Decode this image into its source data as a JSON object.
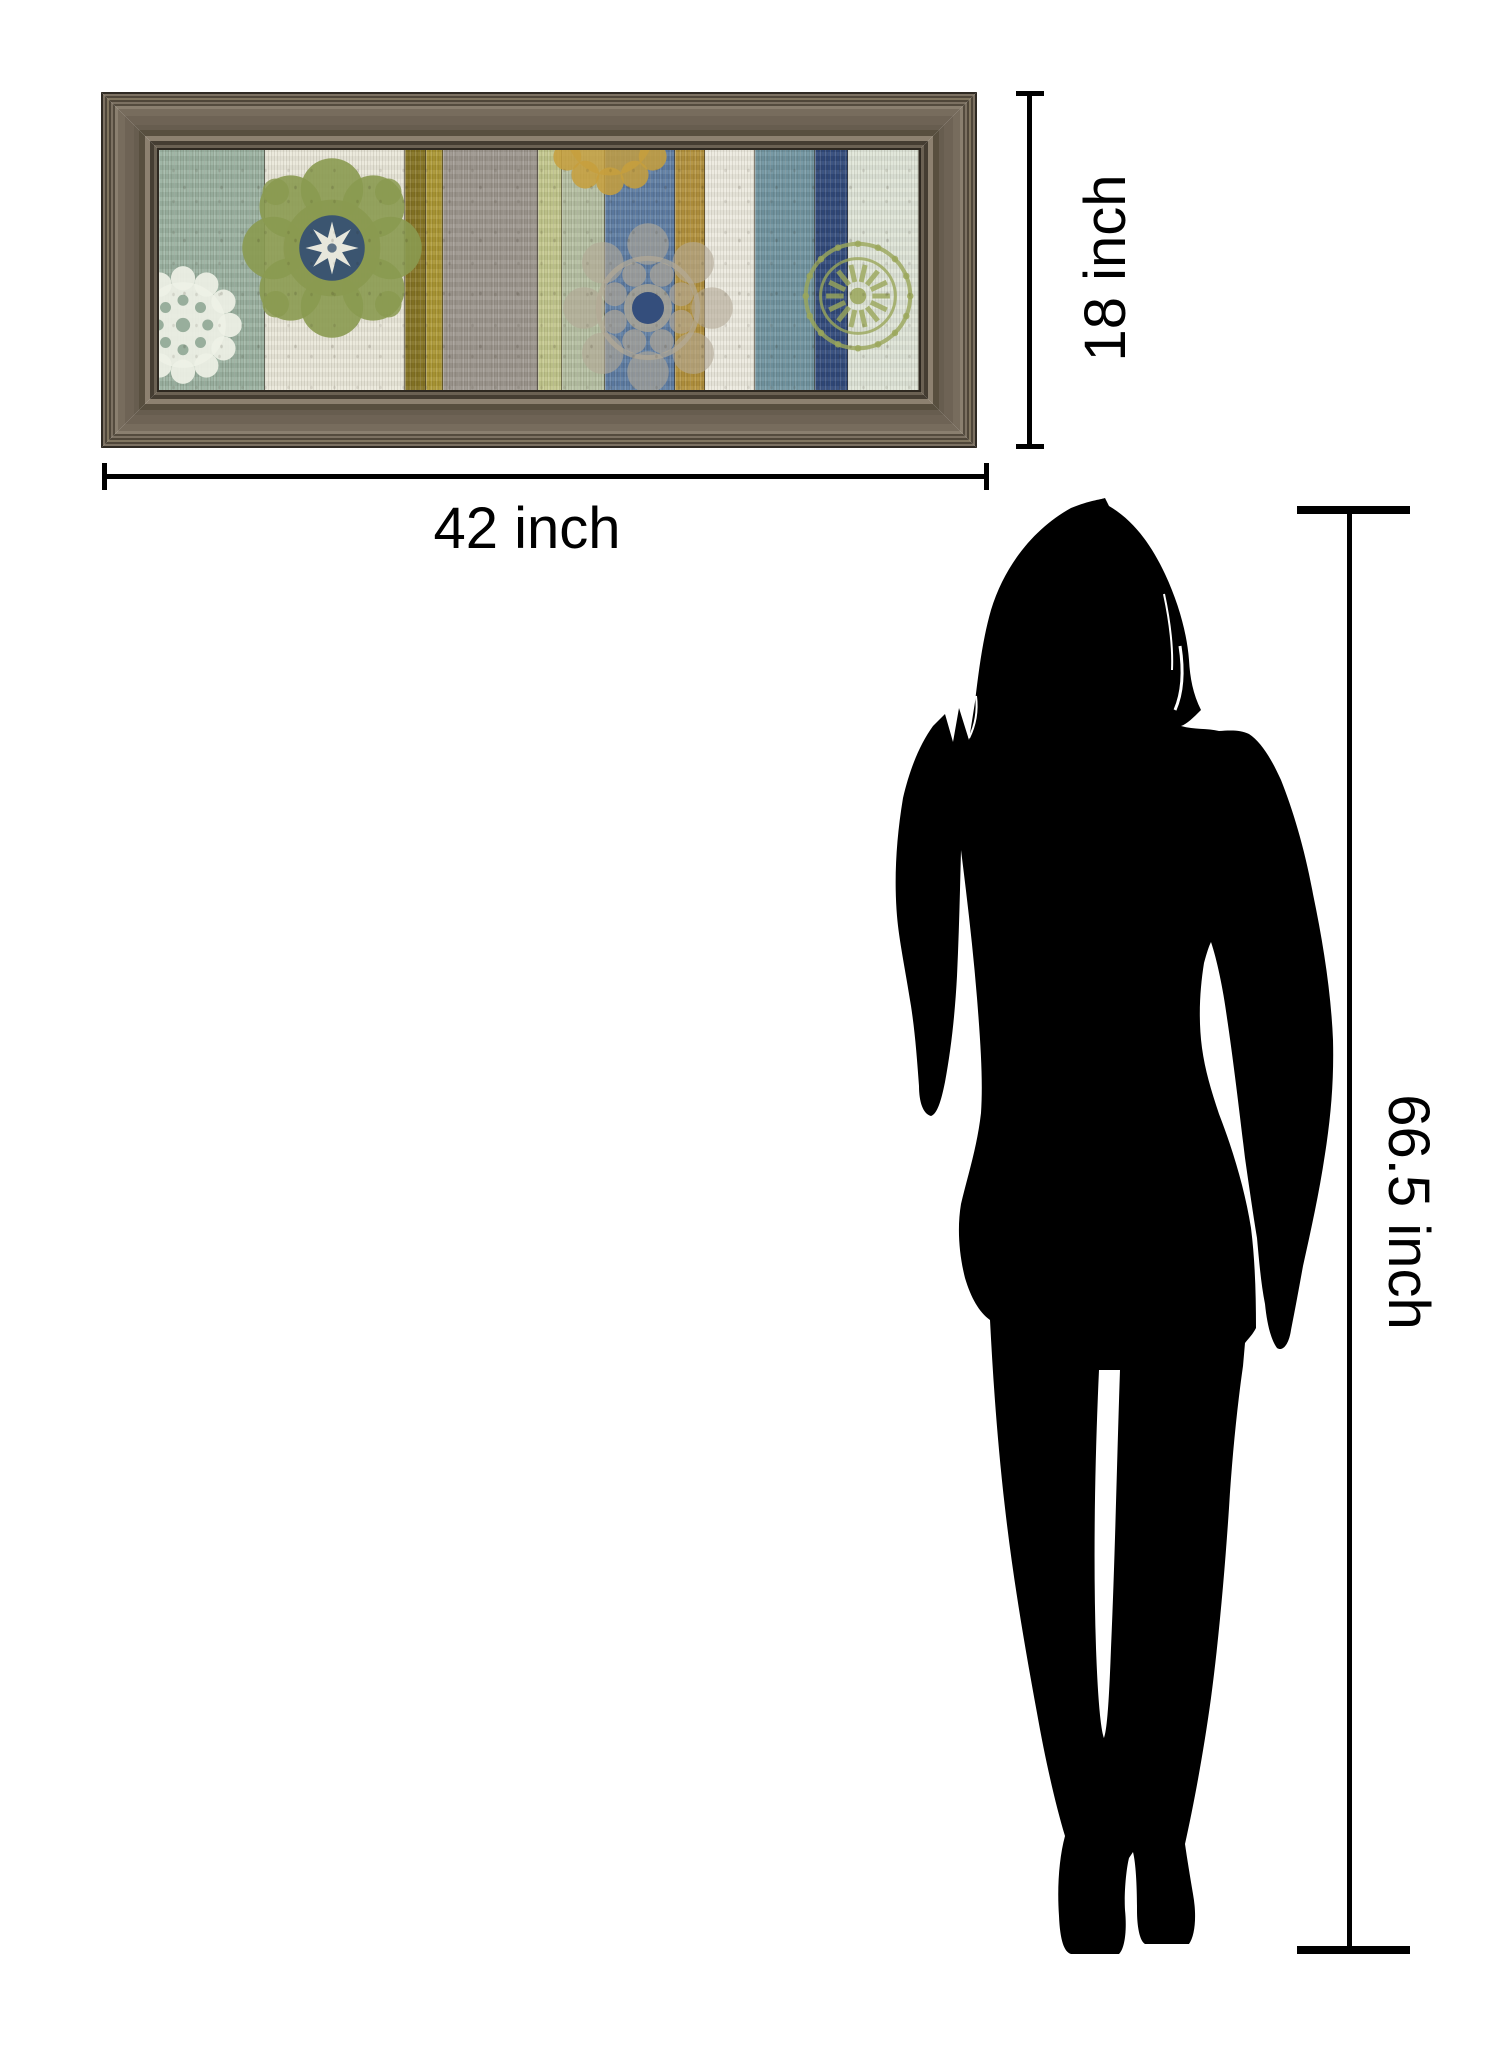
{
  "canvas": {
    "width": 1500,
    "height": 2048,
    "background": "#ffffff"
  },
  "dimensions": {
    "width_label": "42 inch",
    "height_label": "18 inch",
    "person_height_label": "66.5 inch",
    "line_color": "#000000"
  },
  "framed_print": {
    "frame_wood_base": "#6e6355",
    "frame_wood_dark": "#453d32",
    "frame_wood_light": "#8d8170",
    "frame_edge": "#2f2a23",
    "artwork": {
      "style": "distressed painted wood planks with stenciled medallions",
      "planks": [
        {
          "left": 0,
          "width": 106,
          "color": "#9ab1a0"
        },
        {
          "left": 106,
          "width": 140,
          "color": "#eae8da"
        },
        {
          "left": 246,
          "width": 21,
          "color": "#857423"
        },
        {
          "left": 267,
          "width": 17,
          "color": "#ab9733"
        },
        {
          "left": 284,
          "width": 95,
          "color": "#9c968e"
        },
        {
          "left": 379,
          "width": 24,
          "color": "#c2c78c"
        },
        {
          "left": 403,
          "width": 43,
          "color": "#b5bfa2"
        },
        {
          "left": 446,
          "width": 70,
          "color": "#5d7ca3"
        },
        {
          "left": 516,
          "width": 30,
          "color": "#b2913c"
        },
        {
          "left": 546,
          "width": 50,
          "color": "#eceadf"
        },
        {
          "left": 596,
          "width": 60,
          "color": "#7094a0"
        },
        {
          "left": 656,
          "width": 33,
          "color": "#30497b"
        },
        {
          "left": 689,
          "width": 71,
          "color": "#dfe5d8"
        }
      ],
      "medallions": [
        {
          "kind": "lace",
          "name": "white-lace-doily-medallion",
          "cx": 24,
          "cy": 175,
          "r": 55,
          "color": "#eef1e6",
          "accent": "#8fa795"
        },
        {
          "kind": "suzani",
          "name": "green-suzani-medallion",
          "cx": 173,
          "cy": 98,
          "r": 78,
          "color": "#8a9a50",
          "center_color": "#3b5570",
          "star_color": "#f0efe2"
        },
        {
          "kind": "goldPartial",
          "name": "gold-medallion",
          "cx": 451,
          "cy": -18,
          "r": 58,
          "color": "#c79f3c"
        },
        {
          "kind": "ornate",
          "name": "blue-ornate-medallion",
          "cx": 489,
          "cy": 158,
          "r": 80,
          "color": "#b3a996",
          "center_color": "#2e4a7a"
        },
        {
          "kind": "ringStamp",
          "name": "green-ring-stamp-medallion",
          "cx": 699,
          "cy": 146,
          "r": 55,
          "color": "#9aa65a"
        }
      ]
    }
  },
  "silhouette": {
    "description": "standing woman silhouette",
    "color": "#000000"
  }
}
